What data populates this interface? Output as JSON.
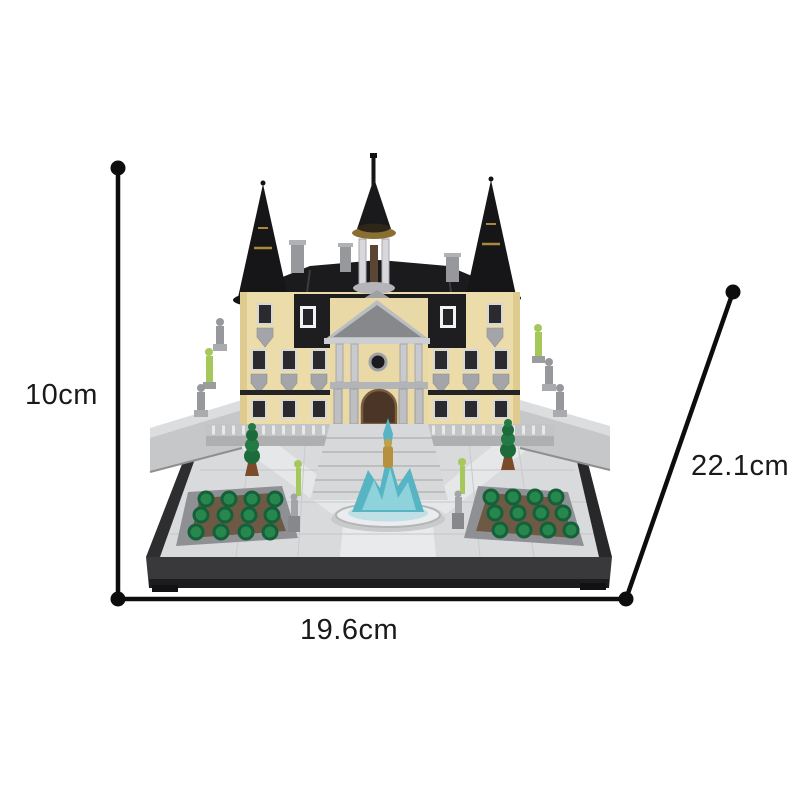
{
  "figure": {
    "type": "product-dimension-diagram",
    "subject": "Brick-built palace model with black spired roofs, front fountain and green gardens on a black display base",
    "labels": {
      "height": "10cm",
      "width": "19.6cm",
      "depth": "22.1cm"
    }
  },
  "palette": {
    "background": "#ffffff",
    "dimension_line": "#0d0d0d",
    "label_text": "#1a1a1a",
    "roof_black": "#1b1b1d",
    "wall_tan": "#ecdcaa",
    "stone_gray": "#c6c7c9",
    "plaza_gray": "#d9dadc",
    "garden_green": "#27874c",
    "fountain_teal": "#57b4c3",
    "fountain_gold": "#b5913d",
    "statue_lime": "#a5c85a"
  }
}
